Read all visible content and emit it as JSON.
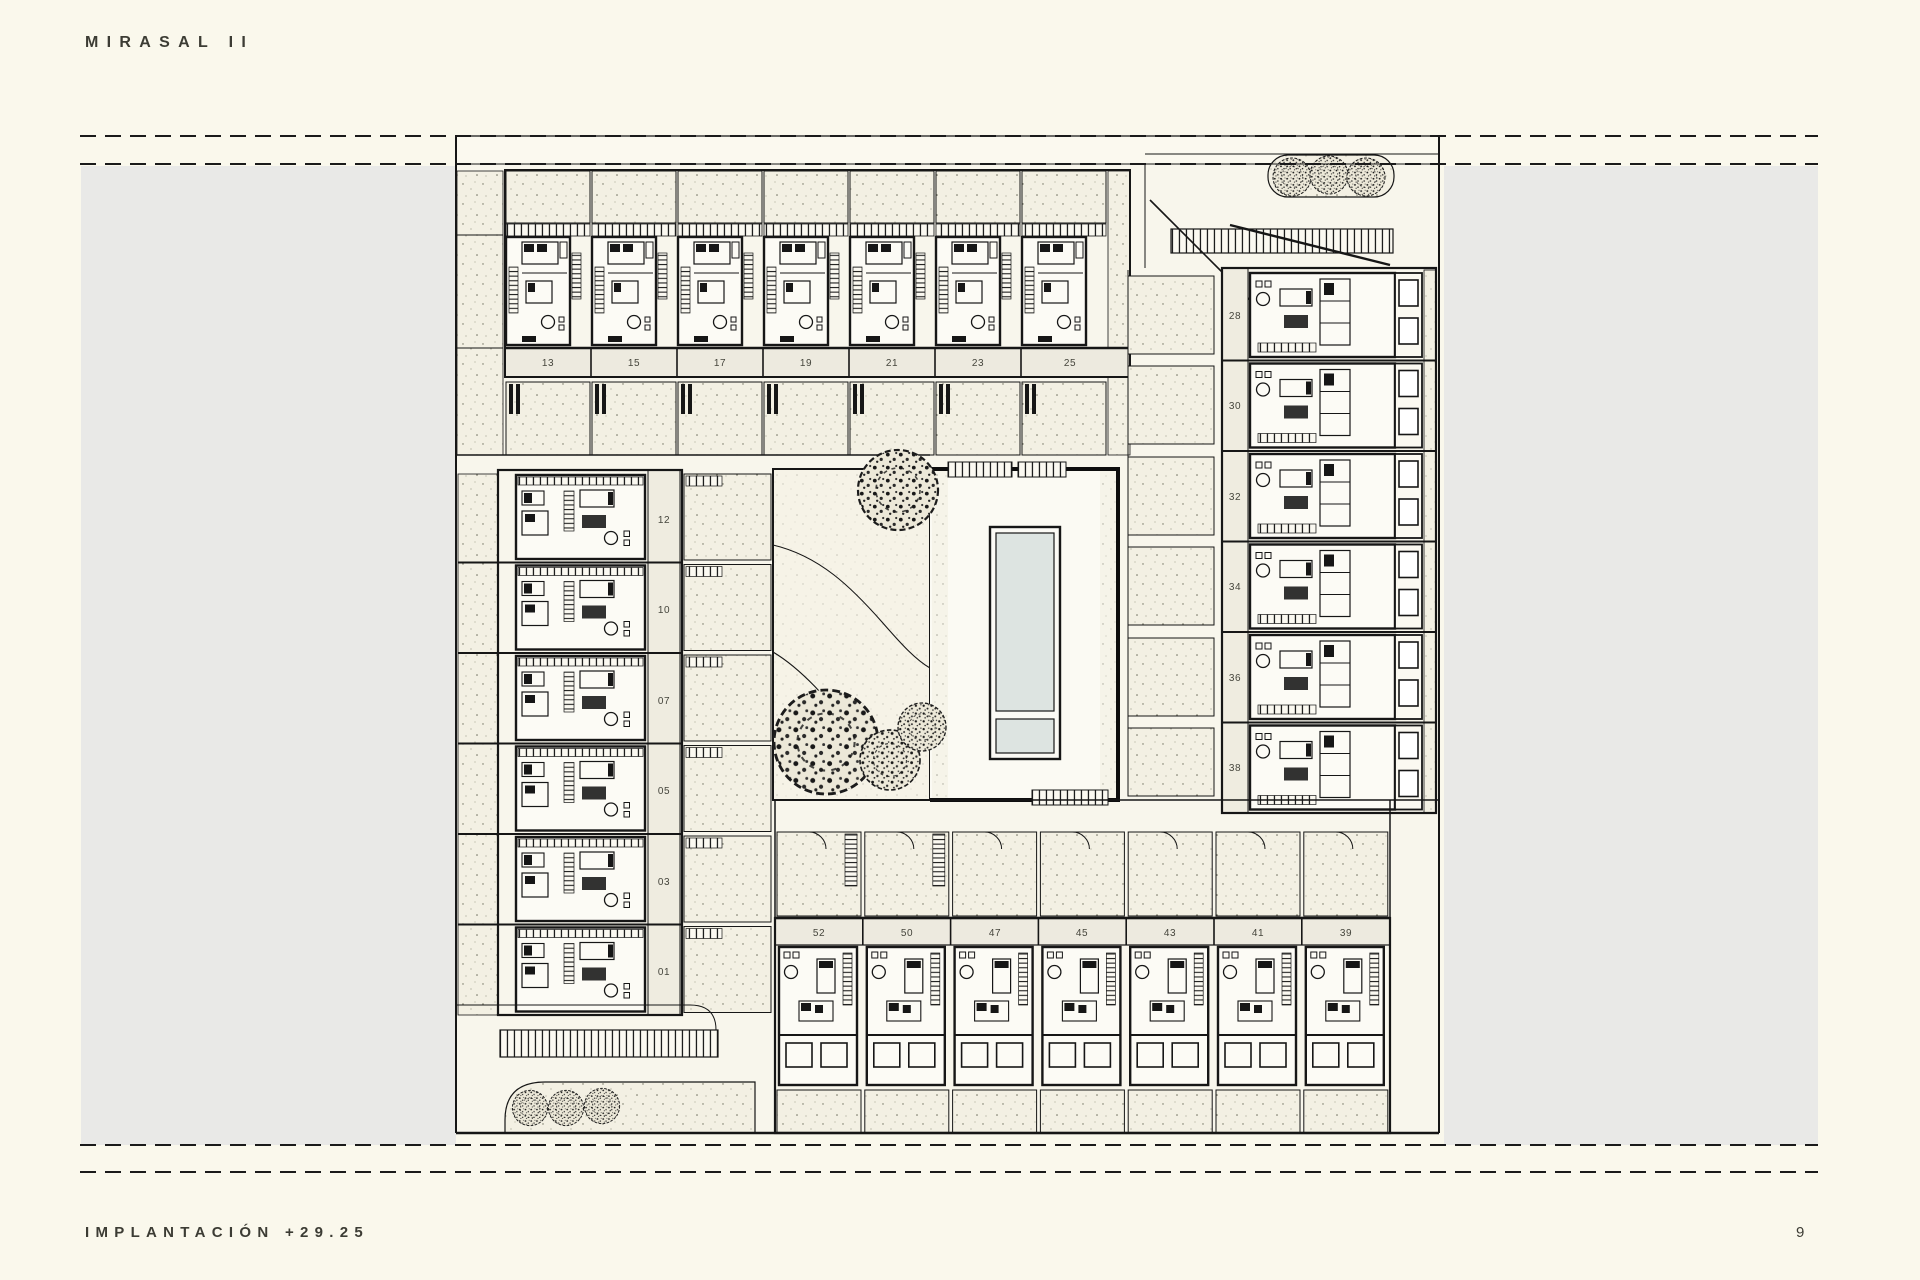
{
  "header": {
    "title": "MIRASAL II"
  },
  "footer": {
    "caption": "IMPLANTACIÓN +29.25",
    "page_number": "9"
  },
  "plan": {
    "top_row_units": [
      "13",
      "15",
      "17",
      "19",
      "21",
      "23",
      "25"
    ],
    "right_column_units": [
      "28",
      "30",
      "32",
      "34",
      "36",
      "38"
    ],
    "left_column_units": [
      "12",
      "10",
      "07",
      "05",
      "03",
      "01"
    ],
    "bottom_row_units": [
      "52",
      "50",
      "47",
      "45",
      "43",
      "41",
      "39"
    ],
    "colors": {
      "paper": "#f8f6ec",
      "side_panel": "#e9e9e7",
      "line": "#161616",
      "pool_water": "#dde4e1",
      "label_band": "#edeadf"
    }
  }
}
